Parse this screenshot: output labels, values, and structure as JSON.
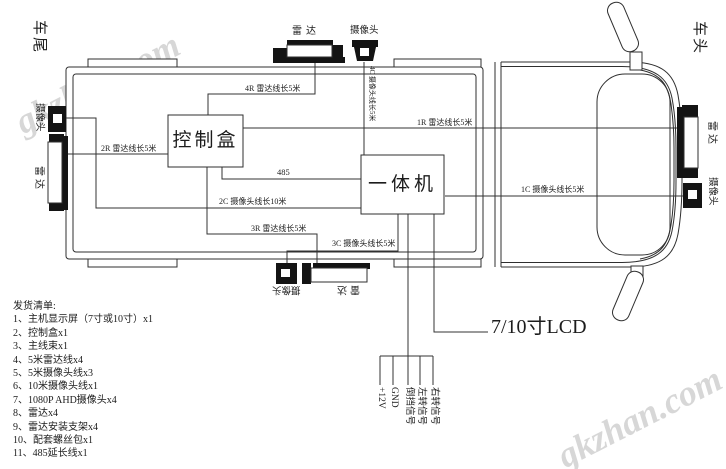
{
  "diagram": {
    "orientation": {
      "rear": "车尾",
      "front": "车头"
    },
    "device_labels": {
      "radar": "雷达",
      "camera": "摄像头"
    },
    "boxes": {
      "control_box": "控制盒",
      "all_in_one": "一体机"
    },
    "wires": {
      "r4": "4R 雷达线长5米",
      "r2": "2R 雷达线长5米",
      "r1": "1R  雷达线长5米",
      "bus485": "485",
      "c2": "2C 摄像头线长10米",
      "r3": "3R 雷达线长5米",
      "c3": "3C 摄像头线长5米",
      "c1": "1C  摄像头线长5米",
      "c4": "4C 摄像头线长5米",
      "lcd": "7/10寸LCD"
    },
    "harness_signals": [
      "+12V",
      "GND",
      "倒挡信号",
      "左转信号",
      "右转信号"
    ]
  },
  "packing_list": {
    "title": "发货清单:",
    "items": [
      "1、主机显示屏（7寸或10寸）x1",
      "2、控制盒x1",
      "3、主线束x1",
      "4、5米雷达线x4",
      "5、5米摄像头线x3",
      "6、10米摄像头线x1",
      "7、1080P AHD摄像头x4",
      "8、雷达x4",
      "9、雷达安装支架x4",
      "10、配套螺丝包x1",
      "11、485延长线x1"
    ]
  },
  "watermark": {
    "text": "gkzhan.com",
    "color": "#d7d7d7"
  },
  "colors": {
    "line": "#2f2f2f",
    "device_fill": "#141414",
    "text": "#1c1c1c",
    "background": "#ffffff"
  }
}
